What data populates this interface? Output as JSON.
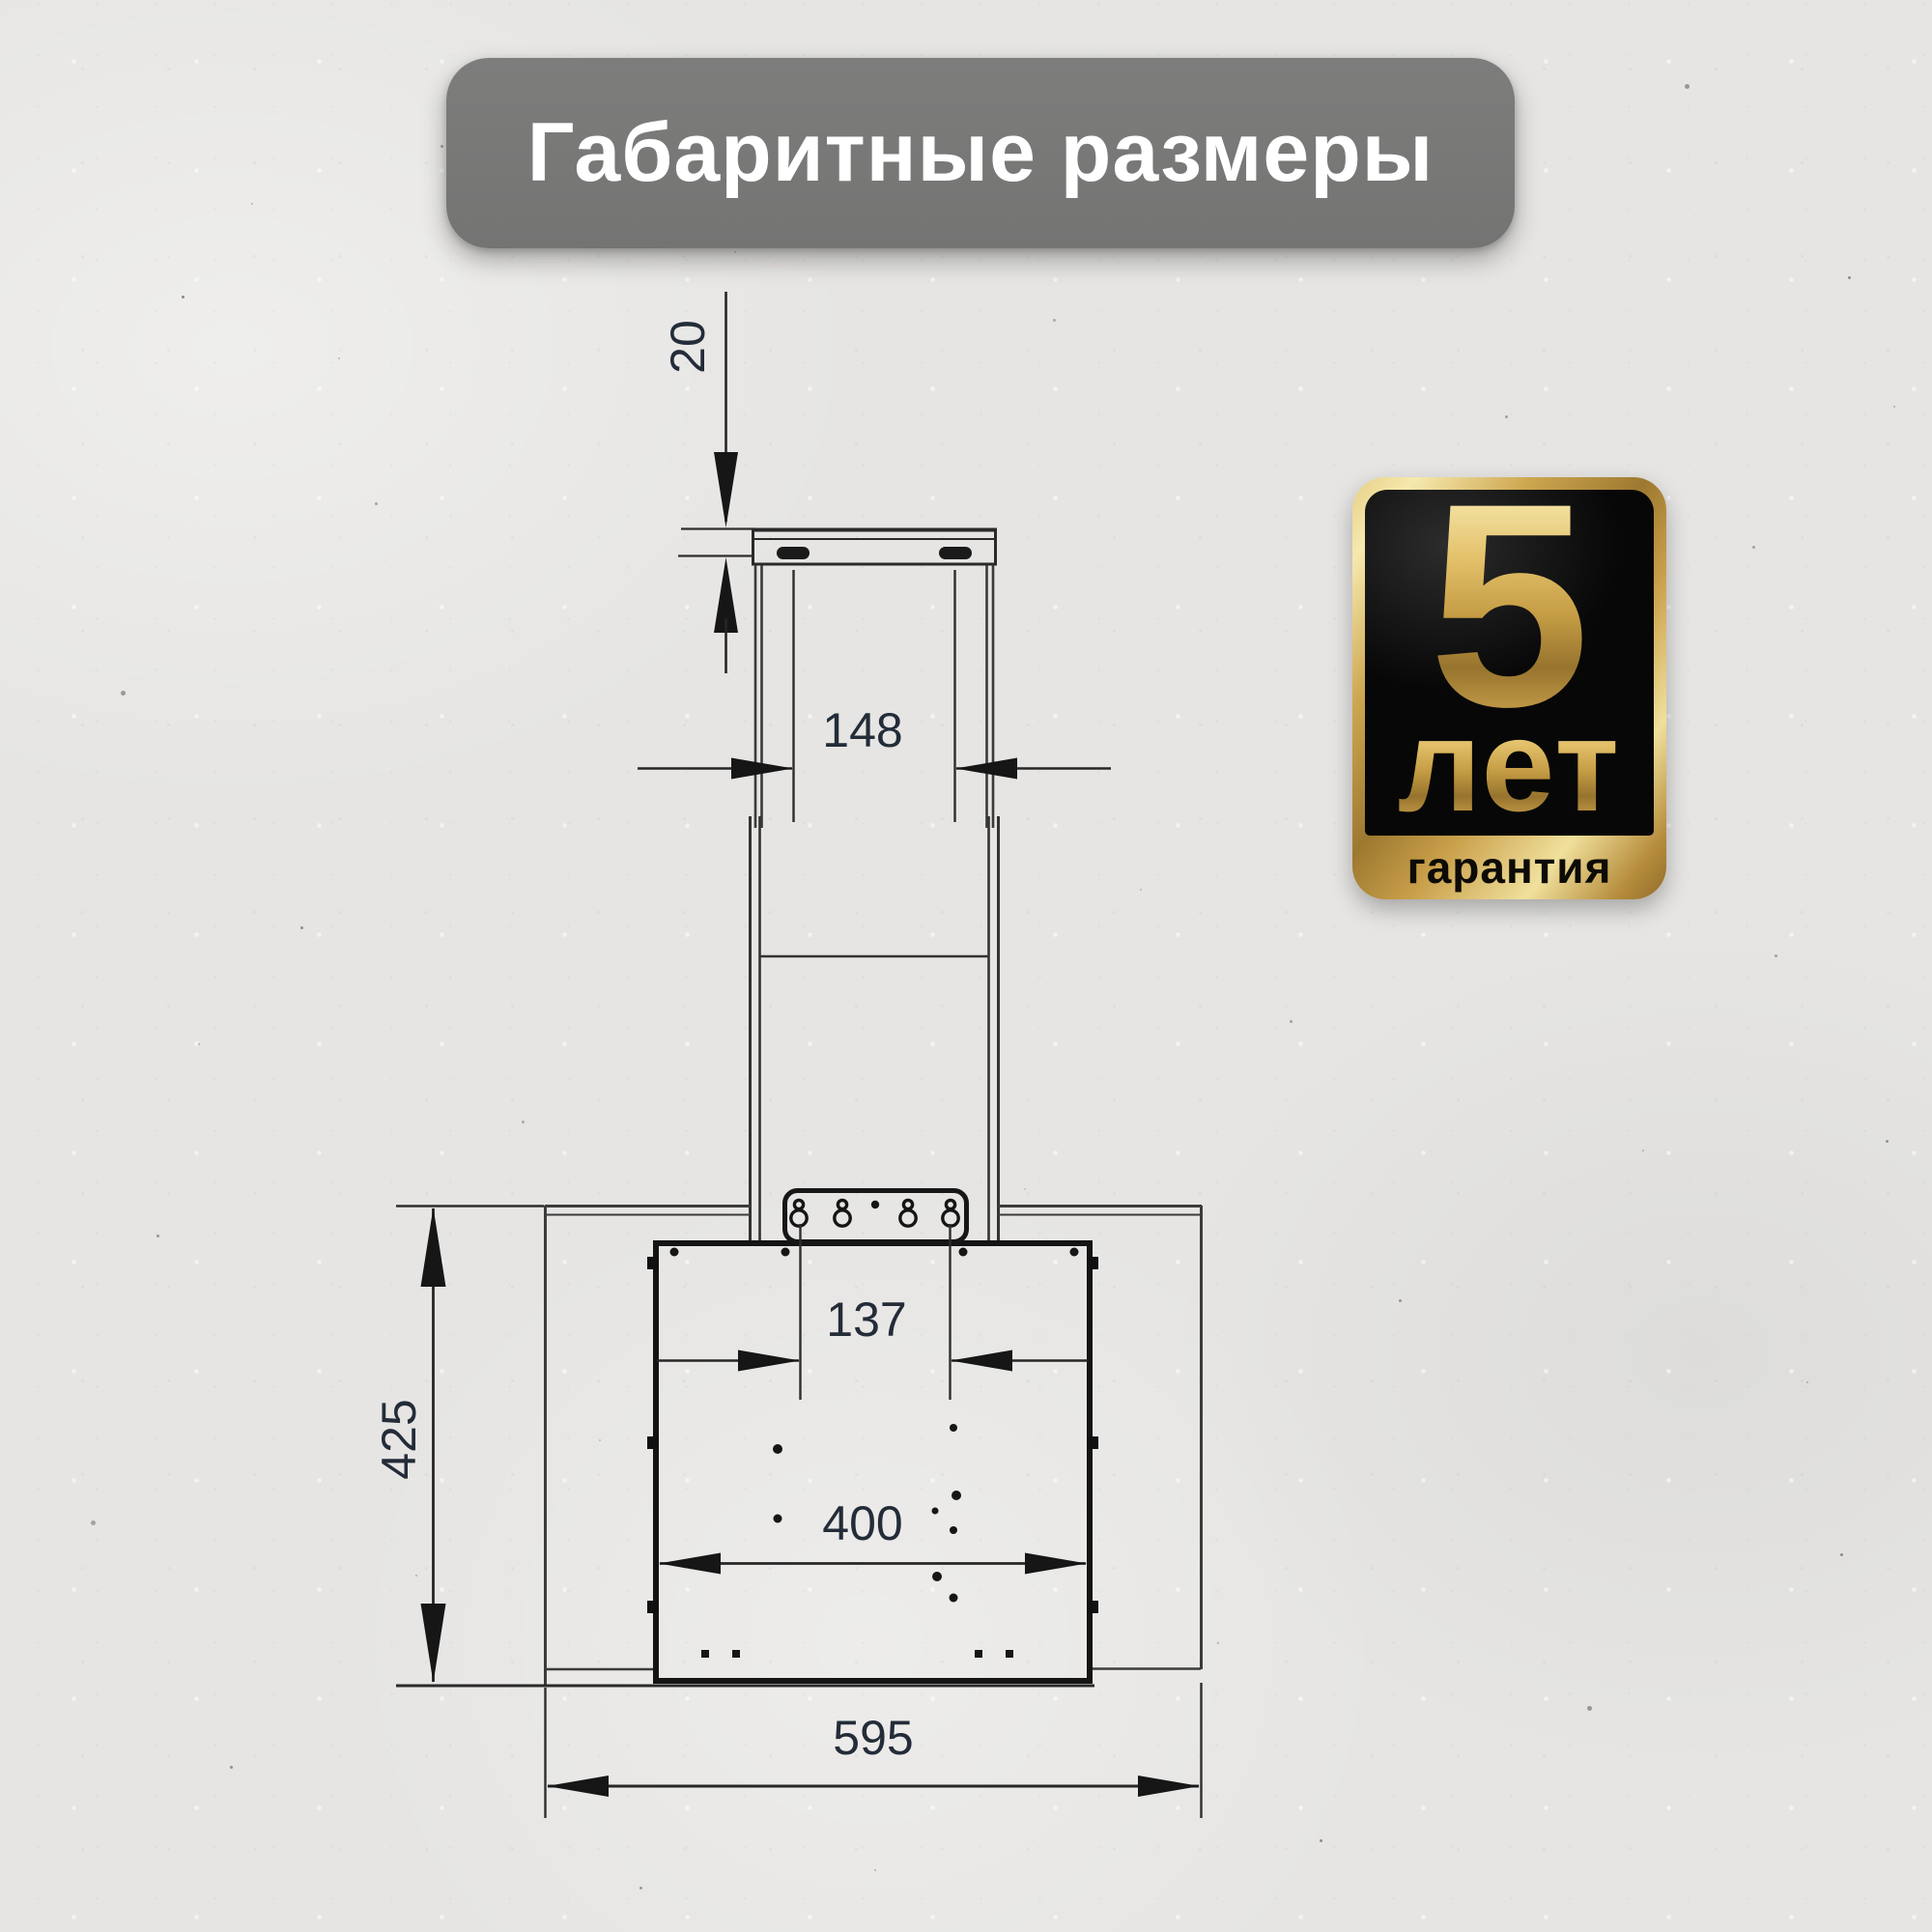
{
  "title": {
    "text": "Габаритные размеры"
  },
  "badge": {
    "years_number": "5",
    "years_word": "лет",
    "bottom_word": "гарантия",
    "gold_hex": "#c9a24d",
    "black_hex": "#0a0a0a"
  },
  "drawing": {
    "type": "dimension-drawing",
    "subject": "kitchen-hood-rear-view",
    "line_hex": "#262626",
    "label_hex": "#232c38",
    "dims": {
      "d20": "20",
      "d148": "148",
      "d137": "137",
      "d400": "400",
      "d425": "425",
      "d595": "595"
    }
  }
}
